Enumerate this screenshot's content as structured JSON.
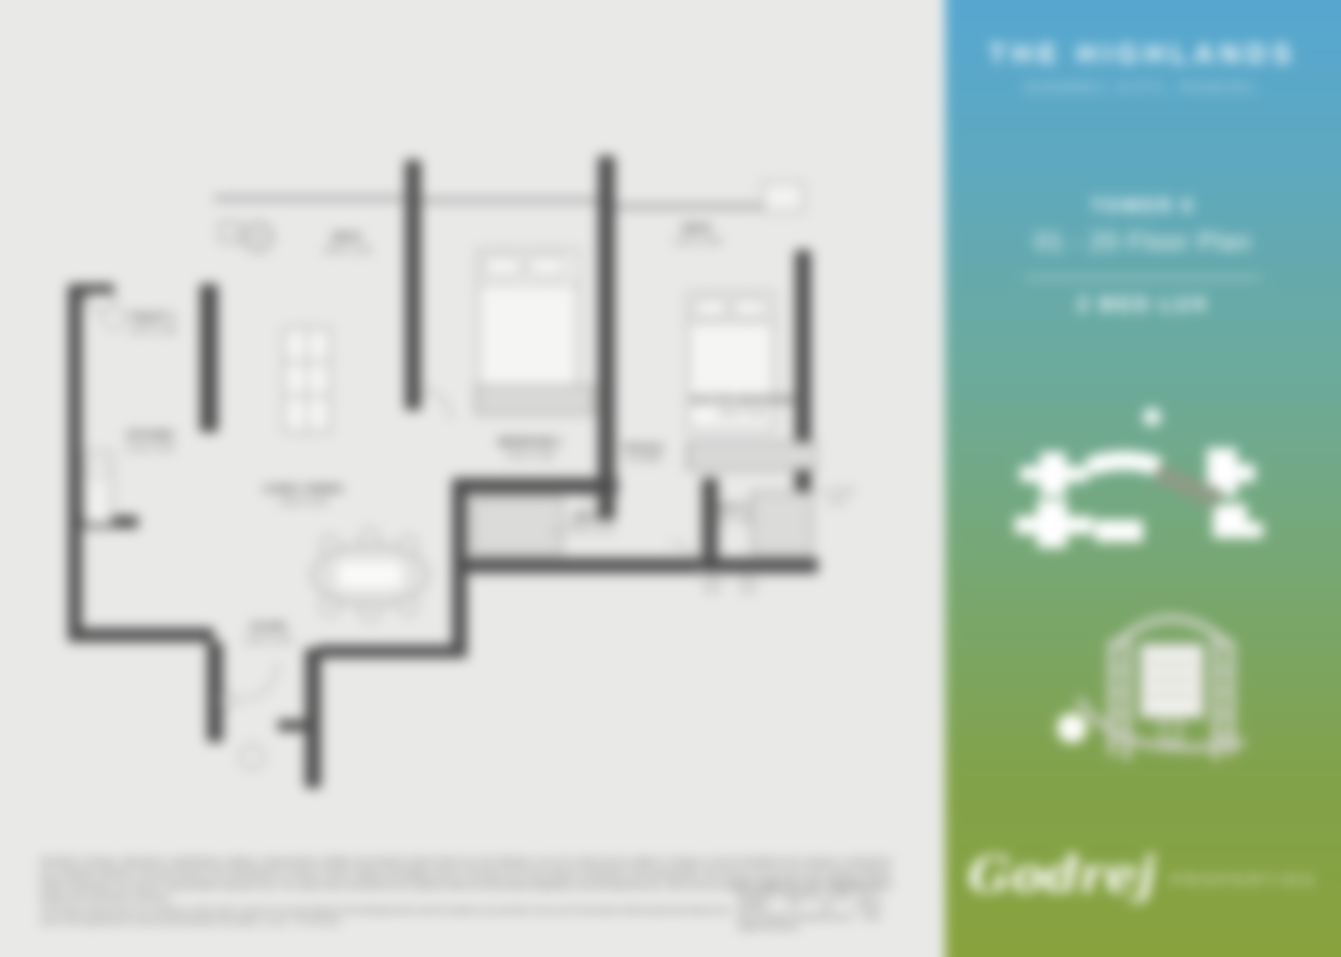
{
  "sidebar": {
    "title": "THE HIGHLANDS",
    "subtitle": "GODREJ CITY, PANVEL",
    "tower": "TOWER 6",
    "floor_range": "01 - 20 Floor Plan",
    "unit_type": "2 BED LUX",
    "colors": {
      "gradient_top": "#55a6d3",
      "gradient_middle": "#6baa9e",
      "gradient_bottom": "#89a23c",
      "text": "#ffffff"
    },
    "icons": {
      "key_plan": "key-plan-icon",
      "tower_illustration": "tower-illustration-icon"
    },
    "logo": {
      "brand": "Godrej",
      "division": "PROPERTIES"
    }
  },
  "plan": {
    "wall_color": "#4d4d4d",
    "background": "#e9e9e8",
    "rooms": [
      {
        "name": "DECK",
        "dims": "3.95 X 1.35"
      },
      {
        "name": "TOILET 1",
        "dims": "1.45 X 2.45"
      },
      {
        "name": "KITCHEN",
        "dims": "2.40 X 3.05"
      },
      {
        "name": "LIVING / DINING",
        "dims": "3.05 X 6.05"
      },
      {
        "name": "BEDROOM 1",
        "dims": "3.05 X 3.60"
      },
      {
        "name": "PASSAGE",
        "dims": "1.20 WIDE"
      },
      {
        "name": "TOILET 2",
        "dims": "1.50 X 2.40"
      },
      {
        "name": "MASTER BEDROOM",
        "dims": "3.60 X 3.05"
      },
      {
        "name": "TOILET 3",
        "dims": "1.45 X 2.45"
      },
      {
        "name": "DECK",
        "dims": "1.35 X 3.95"
      },
      {
        "name": "FOYER",
        "dims": "1.50 X 2.40"
      }
    ],
    "annotations": {
      "flower_bed_1": "FLOWER",
      "flower_bed_2": "BED"
    }
  },
  "disclaimer": {
    "main": "Disclaimer: All plans, dimensions, specifications, designs, measurements, facilities and locations shown herein are only indicative, are not to scale and are subject to change as may be decided by the company or directed by any competent authority in the best interest of the development. Furniture, fixtures, fittings and gadgets shown in the plan are for the purpose of illustration and representation only and do not form part of the standard offering. Artistic impressions are used for representation purposes only. The carpet areas mentioned are as defined under the Real Estate (Regulation and Development) Act, 2016 and are subject to a tolerance of +/- 3% on account of design and construction variances.",
    "sub": "This printed material does not constitute an offer and/or contract of any type between the developer/owner and the recipient; any purchase of any unit in this project shall be governed solely by the terms of the agreement for sale executed between the parties. 1 sq.m. = 10.764 sq.ft.",
    "side": "The project has been registered via MahaRERA Registration Number and is available on the website https://maharera.mahaonline.gov.in under registered projects."
  }
}
